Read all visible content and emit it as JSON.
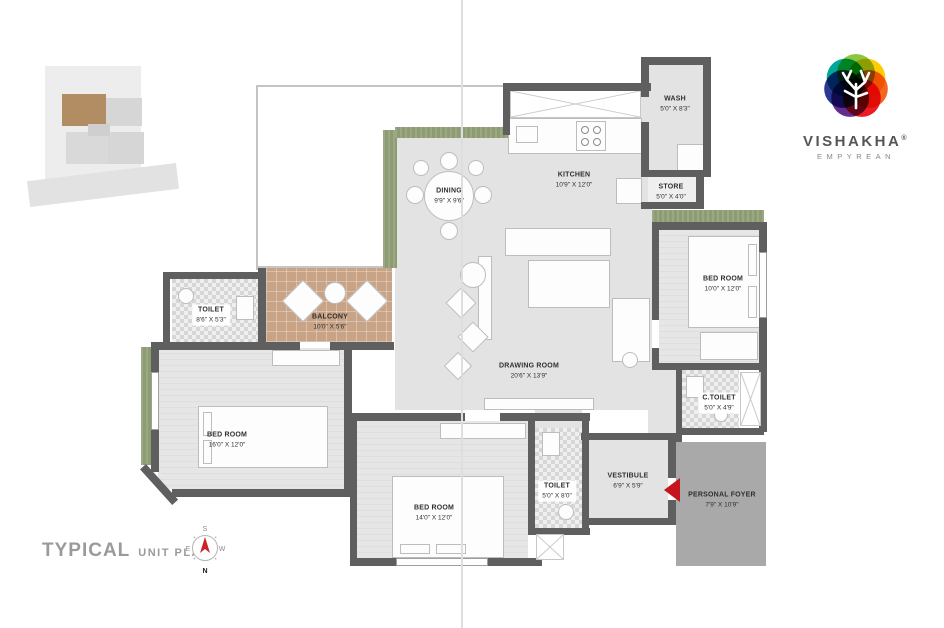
{
  "brand": {
    "name": "VISHAKHA",
    "reg": "®",
    "tagline": "EMPYREAN"
  },
  "titleblock": {
    "title": "TYPICAL",
    "subtitle": "UNIT PLAN"
  },
  "compass": {
    "top": "S",
    "left": "E",
    "right": "W",
    "bottom": "N"
  },
  "rooms": [
    {
      "name": "DINING",
      "dims": "9'9\" X 9'6\""
    },
    {
      "name": "KITCHEN",
      "dims": "10'9\" X 12'0\""
    },
    {
      "name": "WASH",
      "dims": "5'0\" X 8'3\""
    },
    {
      "name": "STORE",
      "dims": "5'0\" X 4'0\""
    },
    {
      "name": "BED ROOM",
      "dims": "10'0\" X 12'0\""
    },
    {
      "name": "TOILET",
      "dims": "8'6\" X 5'3\""
    },
    {
      "name": "BALCONY",
      "dims": "10'0\" X 5'6\""
    },
    {
      "name": "DRAWING ROOM",
      "dims": "20'6\" X 13'9\""
    },
    {
      "name": "BED ROOM",
      "dims": "16'0\" X 12'0\""
    },
    {
      "name": "BED ROOM",
      "dims": "14'0\" X 12'0\""
    },
    {
      "name": "TOILET",
      "dims": "5'0\" X 8'0\""
    },
    {
      "name": "VESTIBULE",
      "dims": "6'9\" X 5'9\""
    },
    {
      "name": "C.TOILET",
      "dims": "5'0\" X 4'9\""
    },
    {
      "name": "PERSONAL FOYER",
      "dims": "7'9\" X 10'9\""
    }
  ],
  "colors": {
    "wall": "#5f5f5f",
    "floor": "#e3e3e3",
    "balcony": "#c9a385",
    "planter": "#8d9c72",
    "foyer": "#a9a9a9",
    "entry_marker_red": "#c4161c",
    "title_gray": "#9a9a9a",
    "logo_palette": [
      "#8dc63f",
      "#ffcb05",
      "#f26522",
      "#ed1c24",
      "#662d91",
      "#2b3990",
      "#00a79d"
    ]
  }
}
